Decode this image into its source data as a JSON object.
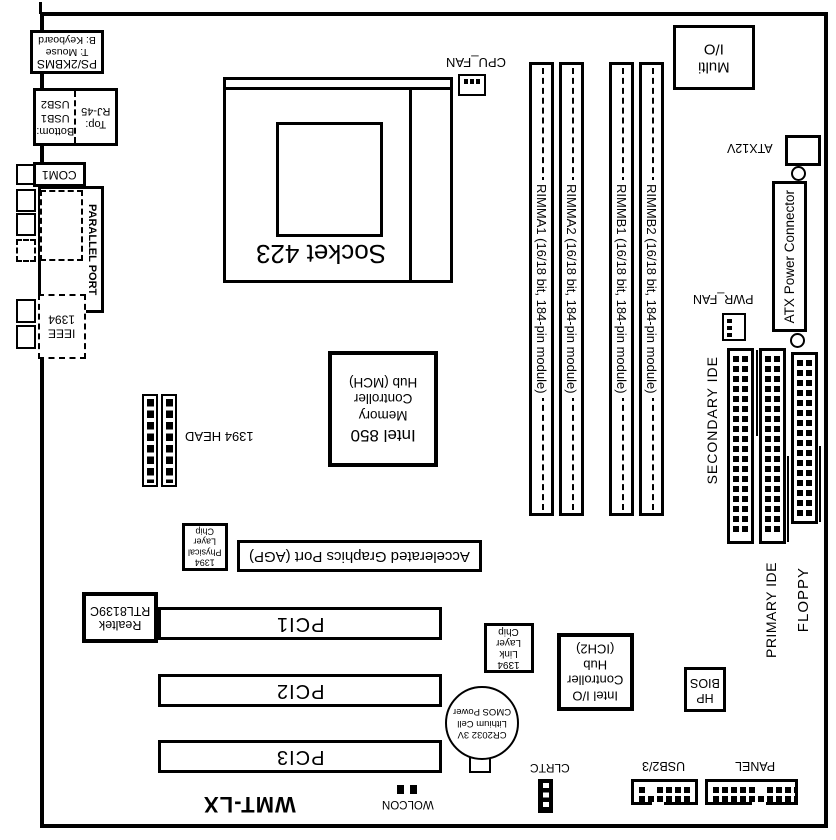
{
  "board": {
    "model": "WMT-LX"
  },
  "colors": {
    "ink": "#000000",
    "paper": "#ffffff"
  },
  "ports": {
    "ps2": {
      "name": "PS/2KBMS",
      "top": "T: Mouse",
      "bottom": "B: Keyboard"
    },
    "usb": {
      "top_label": "Top:",
      "top_port": "RJ-45",
      "bottom_label": "Bottom:",
      "bottom_port1": "USB1",
      "bottom_port2": "USB2"
    },
    "com1": "COM1",
    "parallel": "PARALLEL PORT",
    "ieee1394": {
      "l1": "IEEE",
      "l2": "1394"
    }
  },
  "io": {
    "multi_io": {
      "l1": "Multi",
      "l2": "I/O"
    }
  },
  "cpu": {
    "socket": "Socket 423",
    "fan": "CPU_FAN"
  },
  "memory": {
    "slots": [
      "RIMMA1 (16/18 bit, 184-pin module)",
      "RIMMA2 (16/18 bit, 184-pin module)",
      "RIMMB1 (16/18 bit, 184-pin module)",
      "RIMMB2 (16/18 bit, 184-pin module)"
    ]
  },
  "power": {
    "atx12v": "ATX12V",
    "atx": "ATX Power Connector",
    "pwr_fan": "PWR_FAN"
  },
  "storage": {
    "secondary_ide": "SECONDARY IDE",
    "primary_ide": "PRIMARY IDE",
    "floppy": "FLOPPY"
  },
  "chips": {
    "mch": {
      "l1": "Intel 850",
      "l2": "Memory",
      "l3": "Controller",
      "l4": "Hub (MCH)"
    },
    "ich2": {
      "l1": "Intel I/O",
      "l2": "Controller",
      "l3": "Hub",
      "l4": "(ICH2)"
    },
    "phy1394": {
      "l1": "1394",
      "l2": "Physical",
      "l3": "Layer",
      "l4": "Chip"
    },
    "link1394": {
      "l1": "1394",
      "l2": "Link",
      "l3": "Layer",
      "l4": "Chip"
    },
    "lan": {
      "l1": "Realtek",
      "l2": "RTL8139C"
    },
    "bios": {
      "l1": "HP",
      "l2": "BIOS"
    }
  },
  "slots": {
    "agp": "Accelerated Graphics Port (AGP)",
    "pci": [
      "PCI1",
      "PCI2",
      "PCI3"
    ]
  },
  "headers": {
    "head1394": "1394 HEAD",
    "wolcon": "WOLCON",
    "clrtc": "CLRTC",
    "usb23": "USB2/3",
    "panel": "PANEL"
  },
  "battery": {
    "l1": "CR2032 3V",
    "l2": "Lithium Cell",
    "l3": "CMOS Power"
  }
}
